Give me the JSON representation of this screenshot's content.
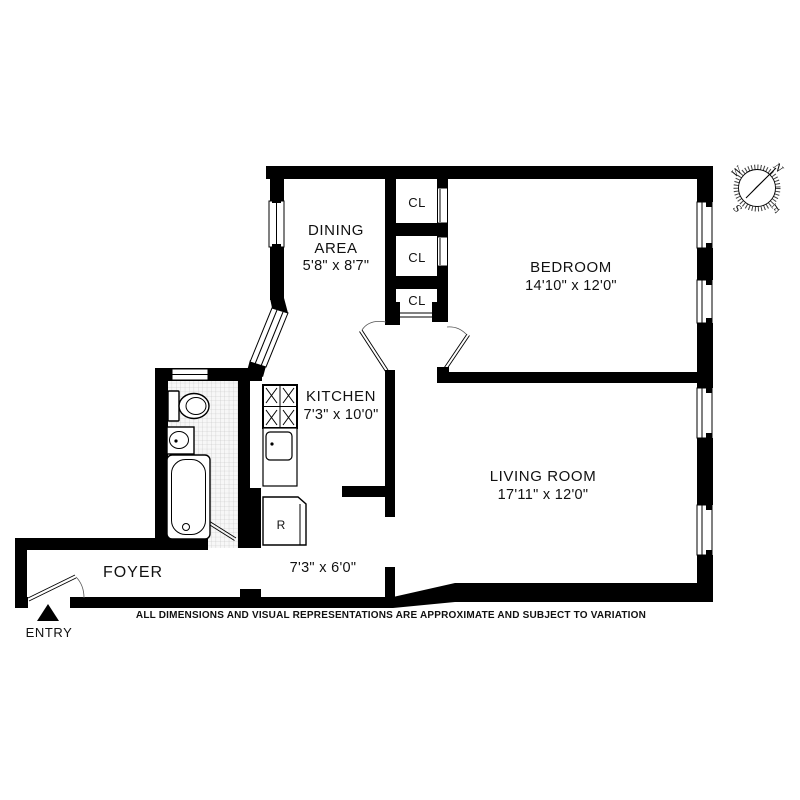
{
  "plan": {
    "rooms": {
      "dining": {
        "name_line1": "DINING",
        "name_line2": "AREA",
        "dims": "5'8\" x 8'7\""
      },
      "bedroom": {
        "name": "BEDROOM",
        "dims": "14'10\" x 12'0\""
      },
      "kitchen": {
        "name": "KITCHEN",
        "dims": "7'3\" x 10'0\""
      },
      "living": {
        "name": "LIVING ROOM",
        "dims": "17'11\" x 12'0\""
      },
      "foyer": {
        "name": "FOYER"
      },
      "hall": {
        "dims": "7'3\" x 6'0\""
      }
    },
    "closets": {
      "label": "CL"
    },
    "fixtures": {
      "refrigerator_label": "R"
    },
    "entry": {
      "label": "ENTRY"
    },
    "compass": {
      "n": "N",
      "e": "E",
      "s": "S",
      "w": "W"
    },
    "disclaimer": "ALL DIMENSIONS AND VISUAL REPRESENTATIONS ARE APPROXIMATE AND SUBJECT TO VARIATION",
    "colors": {
      "wall": "#000000",
      "background": "#ffffff",
      "tile_line": "#bdbdbd"
    }
  }
}
